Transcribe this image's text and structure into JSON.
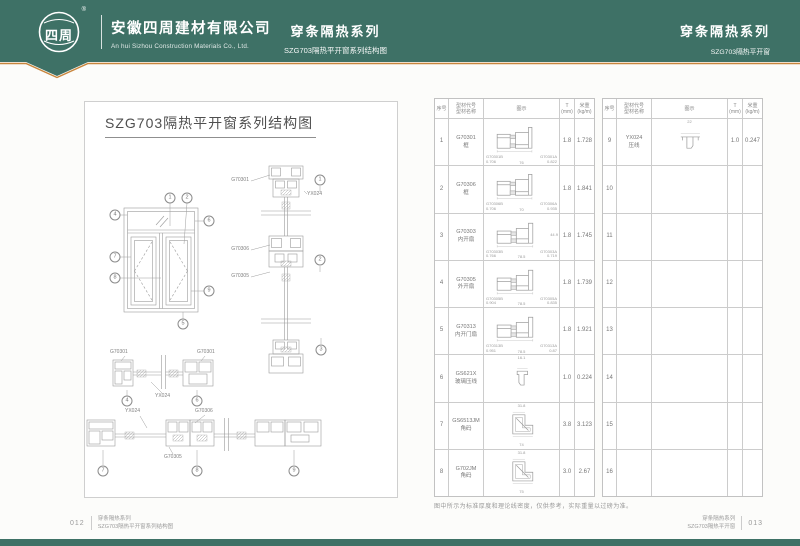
{
  "header": {
    "logo_text": "四周",
    "registered_mark": "®",
    "company_cn": "安徽四周建材有限公司",
    "company_en": "An hui Sizhou Construction Materials Co., Ltd.",
    "center_series_title": "穿条隔热系列",
    "center_series_subtitle": "SZG703隔热平开窗系列结构图",
    "right_series_title": "穿条隔热系列",
    "right_series_subtitle": "SZG703隔热平开窗"
  },
  "left_page": {
    "title": "SZG703隔热平开窗系列结构图",
    "section_labels": {
      "vs_top": "G70301",
      "vs_bead": "YX024",
      "vs_mid": "G70306",
      "vs_bot": "G70305",
      "hs1_left": "G70301",
      "hs1_right": "G70301",
      "hs1_bead": "YX024",
      "hs2_bead": "YX024",
      "hs2_frame": "G70306",
      "hs2_sash": "G70305"
    },
    "callouts": [
      "1",
      "2",
      "4",
      "6",
      "7",
      "8",
      "9",
      "5",
      "1",
      "2",
      "3",
      "4",
      "6",
      "7",
      "8",
      "9"
    ]
  },
  "right_page": {
    "note": "图中所示为标准厚度和理论线密度，仅供参考，实际重量以过磅为准。",
    "table": {
      "col_no": "序号",
      "col_code_line1": "型材代号",
      "col_code_line2": "型材名称",
      "col_diagram": "图示",
      "col_t_line1": "T",
      "col_t_line2": "(mm)",
      "col_weight_line1": "米重",
      "col_weight_line2": "(kg/m)",
      "left_rows": [
        {
          "no": "1",
          "code": "G70301",
          "name": "框",
          "t": "1.8",
          "weight": "1.728",
          "glyph": "frame",
          "dim_l": "G70301B",
          "dim_lv": "0.706",
          "dim_w": "76",
          "dim_r": "G70301A",
          "dim_rv": "0.822"
        },
        {
          "no": "2",
          "code": "G70306",
          "name": "框",
          "t": "1.8",
          "weight": "1.841",
          "glyph": "frame",
          "dim_l": "G70306B",
          "dim_lv": "0.706",
          "dim_w": "70",
          "dim_r": "G70306A",
          "dim_rv": "0.935"
        },
        {
          "no": "3",
          "code": "G70303",
          "name": "内开扇",
          "t": "1.8",
          "weight": "1.745",
          "glyph": "sash",
          "dim_l": "G70303B",
          "dim_lv": "0.766",
          "dim_w": "78.5",
          "dim_r": "G70303A",
          "dim_rv": "0.719",
          "dim_h": "44.9"
        },
        {
          "no": "4",
          "code": "G70305",
          "name": "外开扇",
          "t": "1.8",
          "weight": "1.739",
          "glyph": "sash",
          "dim_l": "G70305B",
          "dim_lv": "0.904",
          "dim_w": "78.5",
          "dim_r": "G70305A",
          "dim_rv": "0.835"
        },
        {
          "no": "5",
          "code": "G70313",
          "name": "内开门扇",
          "t": "1.8",
          "weight": "1.921",
          "glyph": "sash",
          "dim_l": "G70313B",
          "dim_lv": "0.951",
          "dim_w": "78.5",
          "dim_r": "G70313A",
          "dim_rv": "0.87"
        },
        {
          "no": "6",
          "code": "GS621X",
          "name": "玻璃压线",
          "t": "1.0",
          "weight": "0.224",
          "glyph": "bead",
          "dim_top": "16.1"
        },
        {
          "no": "7",
          "code": "GS6513JM",
          "name": "角码",
          "t": "3.8",
          "weight": "3.123",
          "glyph": "corner",
          "dim_top": "31.8",
          "dim_b": "74"
        },
        {
          "no": "8",
          "code": "G702JM",
          "name": "角码",
          "t": "3.0",
          "weight": "2.67",
          "glyph": "corner",
          "dim_top": "31.8",
          "dim_b": "75"
        }
      ],
      "right_rows": [
        {
          "no": "9",
          "code": "YX024",
          "name": "压线",
          "t": "1.0",
          "weight": "0.247",
          "glyph": "bead9",
          "dim_top": "22"
        },
        {
          "no": "10"
        },
        {
          "no": "11"
        },
        {
          "no": "12"
        },
        {
          "no": "13"
        },
        {
          "no": "14"
        },
        {
          "no": "15"
        },
        {
          "no": "16"
        }
      ]
    }
  },
  "footer": {
    "left_page_number": "012",
    "left_series": "穿条隔热系列",
    "left_subtitle": "SZG703隔热平开窗系列结构图",
    "right_page_number": "013",
    "right_series": "穿条隔热系列",
    "right_subtitle": "SZG703隔热平开窗"
  },
  "colors": {
    "header_green": "#3e7166",
    "accent_orange": "#c8853c"
  }
}
